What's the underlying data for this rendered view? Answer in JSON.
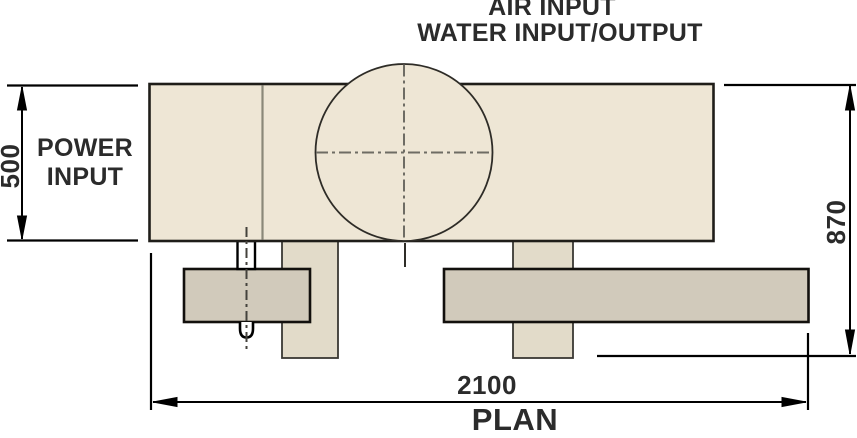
{
  "drawing": {
    "view_label": "PLAN",
    "labels": {
      "air_input": "AIR INPUT",
      "water_input_output": "WATER INPUT/OUTPUT",
      "power_input": "POWER INPUT"
    },
    "dimensions": {
      "body_depth": "500",
      "overall_depth": "870",
      "overall_width": "2100"
    },
    "colors": {
      "body_fill": "#EEE6D5",
      "foot_fill": "#E2DBC9",
      "rail_fill": "#D1CABB",
      "gland_fill": "#FFFFFF",
      "outline": "#23211D",
      "seam_line": "#8B8879",
      "centerline": "#6E6C64",
      "cable_centerline": "#44423C",
      "dimension_line": "#000000",
      "text": "#2B2B2B"
    }
  }
}
